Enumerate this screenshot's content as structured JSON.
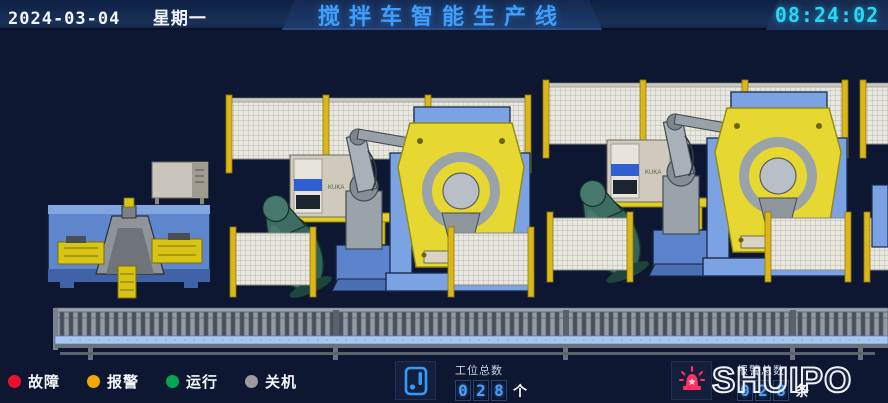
{
  "header": {
    "date": "2024-03-04",
    "weekday": "星期一",
    "title": "搅拌车智能生产线",
    "time": "08:24:02"
  },
  "scene": {
    "cabinet_label": "KUKA"
  },
  "status_bar": {
    "legend": [
      {
        "id": "fault",
        "label": "故障",
        "color": "#e8112d"
      },
      {
        "id": "alarm",
        "label": "报警",
        "color": "#f2a900"
      },
      {
        "id": "run",
        "label": "运行",
        "color": "#00a651"
      },
      {
        "id": "off",
        "label": "关机",
        "color": "#9a9aa0"
      }
    ],
    "station_counter": {
      "label": "工位总数",
      "digits": [
        "0",
        "2",
        "8"
      ],
      "unit": "个"
    },
    "alarm_counter": {
      "label": "报警总数",
      "digits": [
        "0",
        "2",
        "8"
      ],
      "unit": "条"
    },
    "logo": "SHUIPO"
  },
  "colors": {
    "title_blue": "#3f9dfc",
    "time_cyan": "#27d8f5",
    "beacon_pink": "#ff2e63",
    "counter_digit_blue": "#4f9bf5"
  }
}
